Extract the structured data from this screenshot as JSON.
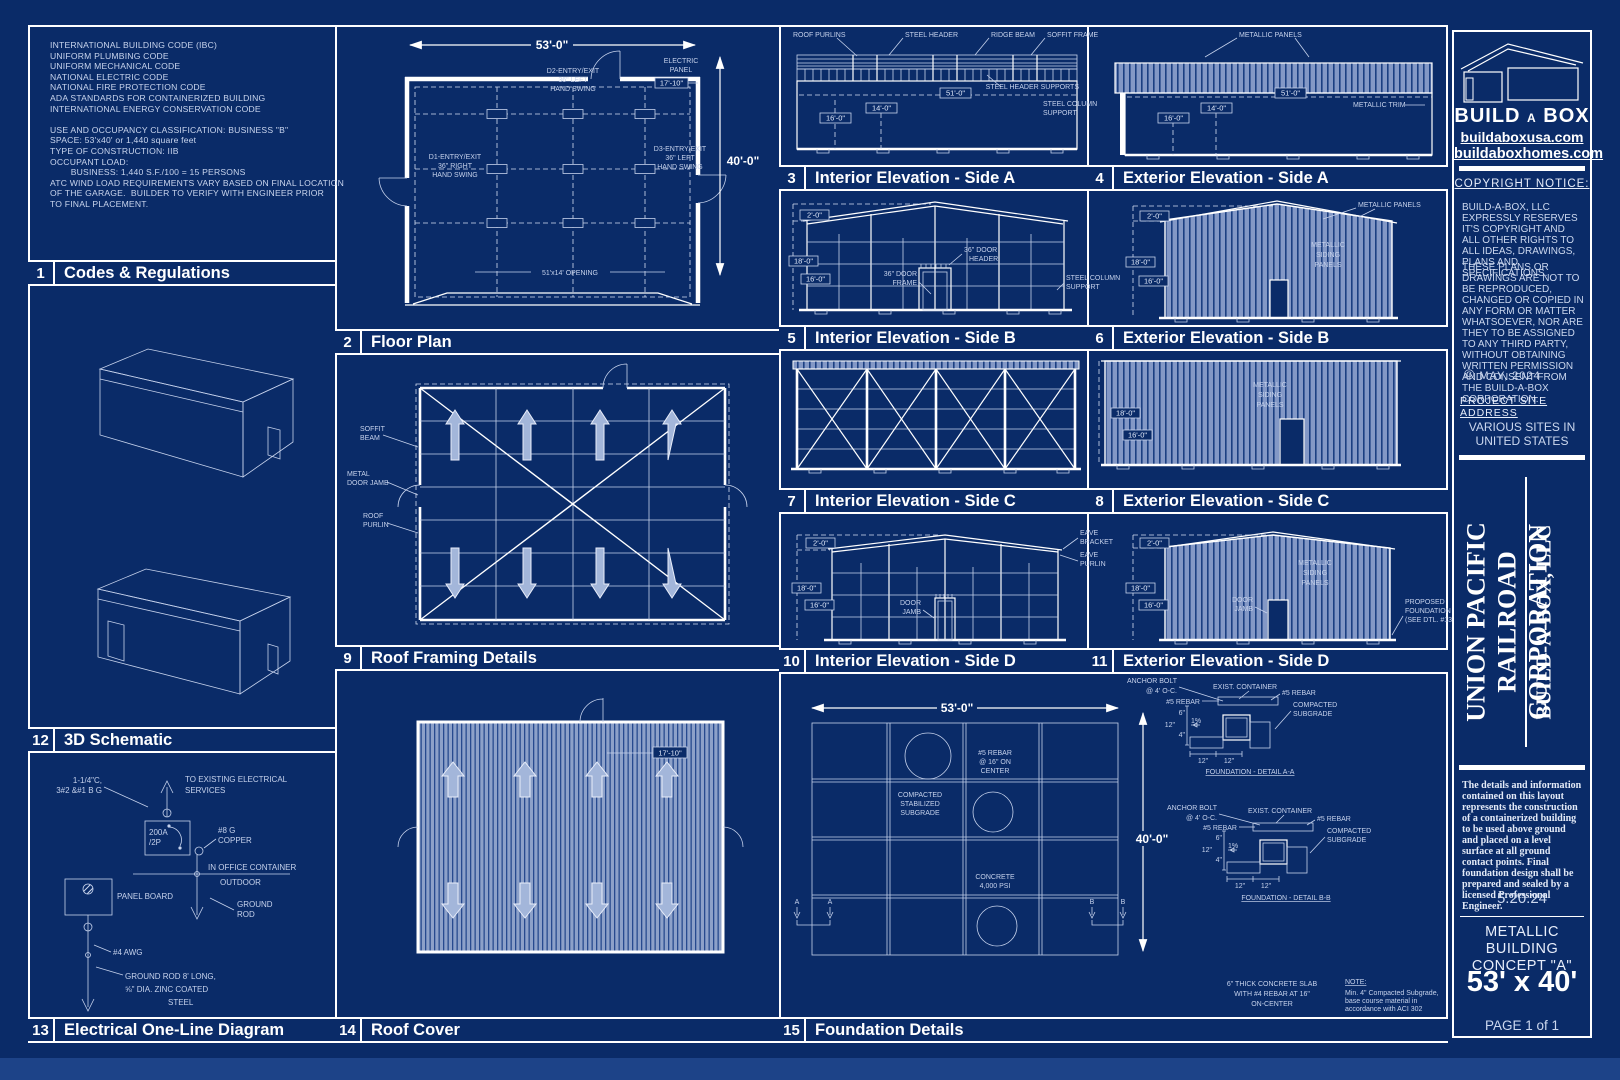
{
  "p1": {
    "num": "1",
    "title": "Codes & Regulations",
    "lines": [
      "INTERNATIONAL BUILDING CODE (IBC)",
      "UNIFORM PLUMBING CODE",
      "UNIFORM MECHANICAL CODE",
      "NATIONAL ELECTRIC CODE",
      "NATIONAL FIRE PROTECTION CODE",
      "ADA STANDARDS FOR CONTAINERIZED BUILDING",
      "INTERNATIONAL ENERGY CONSERVATION CODE",
      "",
      "USE AND OCCUPANCY CLASSIFICATION: BUSINESS \"B\"",
      "SPACE: 53'x40' or 1,440 square feet",
      "TYPE OF CONSTRUCTION: IIB",
      "OCCUPANT LOAD:",
      "        BUSINESS: 1,440 S.F./100 = 15 PERSONS",
      "ATC WIND LOAD REQUIREMENTS VARY BASED ON FINAL LOCATION",
      "OF THE GARAGE.  BUILDER TO VERIFY WITH ENGINEER PRIOR",
      "TO FINAL PLACEMENT."
    ]
  },
  "p2": {
    "num": "2",
    "title": "Floor Plan",
    "dim_w": "53'-0\"",
    "dim_h": "40'-0\"",
    "d1": [
      "D1-ENTRY/EXIT",
      "36\" RIGHT",
      "HAND SWING"
    ],
    "d2": [
      "D2-ENTRY/EXIT",
      "36\" LEFT",
      "HAND SWING"
    ],
    "d3": [
      "D3-ENTRY/EXIT",
      "36\" LEFT",
      "HAND SWING"
    ],
    "electric": [
      "ELECTRIC",
      "PANEL"
    ],
    "panel_dim": "17'-10\"",
    "opening": "51'x14' OPENING"
  },
  "p3": {
    "num": "3",
    "title": "Interior Elevation - Side A",
    "roof_purlins": "ROOF PURLINS",
    "steel_header": "STEEL HEADER",
    "ridge_beam": "RIDGE BEAM",
    "soffit_frame": "SOFFIT FRAME",
    "header_supports": "STEEL HEADER SUPPORTS",
    "column_support": [
      "STEEL COLUMN",
      "SUPPORT"
    ],
    "dims": [
      "16'-0\"",
      "14'-0\"",
      "51'-0\""
    ]
  },
  "p4": {
    "num": "4",
    "title": "Exterior Elevation - Side A",
    "metallic_panels": "METALLIC PANELS",
    "metallic_trim": "METALLIC TRIM",
    "dims": [
      "16'-0\"",
      "14'-0\"",
      "51'-0\""
    ]
  },
  "p5": {
    "num": "5",
    "title": "Interior Elevation - Side B",
    "door_header": [
      "36\" DOOR",
      "HEADER"
    ],
    "door_frame": [
      "36\" DOOR",
      "FRAME"
    ],
    "column_support": [
      "STEEL COLUMN",
      "SUPPORT"
    ],
    "dims": [
      "2'-0\"",
      "18'-0\"",
      "16'-0\""
    ]
  },
  "p6": {
    "num": "6",
    "title": "Exterior Elevation - Side B",
    "metallic_panels": "METALLIC PANELS",
    "siding": [
      "METALLIC",
      "SIDING",
      "PANELS"
    ],
    "dims": [
      "2'-0\"",
      "18'-0\"",
      "16'-0\""
    ]
  },
  "p7": {
    "num": "7",
    "title": "Interior Elevation - Side C"
  },
  "p8": {
    "num": "8",
    "title": "Exterior Elevation - Side C",
    "siding": [
      "METALLIC",
      "SIDING",
      "PANELS"
    ],
    "dims": [
      "18'-0\"",
      "16'-0\""
    ]
  },
  "p9": {
    "num": "9",
    "title": "Roof Framing Details",
    "soffit_beam": [
      "SOFFIT",
      "BEAM"
    ],
    "door_jamb": [
      "METAL",
      "DOOR JAMB"
    ],
    "roof_purlin": [
      "ROOF",
      "PURLIN"
    ]
  },
  "p10": {
    "num": "10",
    "title": "Interior Elevation - Side D",
    "door_jamb": [
      "DOOR",
      "JAMB"
    ],
    "eave_bracket": [
      "EAVE",
      "BRACKET"
    ],
    "eave_purlin": [
      "EAVE",
      "PURLIN"
    ],
    "dims": [
      "2'-0\"",
      "18'-0\"",
      "16'-0\""
    ]
  },
  "p11": {
    "num": "11",
    "title": "Exterior Elevation - Side D",
    "door_jamb": [
      "DOOR",
      "JAMB"
    ],
    "siding": [
      "METALLIC",
      "SIDING",
      "PANELS"
    ],
    "foundation": [
      "PROPOSED",
      "FOUNDATION",
      "(SEE DTL. #13)"
    ],
    "dims": [
      "2'-0\"",
      "18'-0\"",
      "16'-0\""
    ]
  },
  "p12": {
    "num": "12",
    "title": "3D Schematic"
  },
  "p13": {
    "num": "13",
    "title": "Electrical One-Line Diagram",
    "feed": [
      "1-1/4\"C,",
      "3#2 &#1 B G"
    ],
    "services": [
      "TO EXISTING ELECTRICAL",
      "SERVICES"
    ],
    "breaker": [
      "200A",
      "/2P"
    ],
    "copper": [
      "#8 G",
      "COPPER"
    ],
    "in_office": "IN OFFICE CONTAINER",
    "outdoor": "OUTDOOR",
    "panel_board": "PANEL BOARD",
    "ground_rod": [
      "GROUND",
      "ROD"
    ],
    "awg": "#4 AWG",
    "rod_note": [
      "GROUND ROD 8' LONG,",
      "⅝\" DIA. ZINC COATED",
      "STEEL"
    ]
  },
  "p14": {
    "num": "14",
    "title": "Roof Cover",
    "dim": "17'-10\""
  },
  "p15": {
    "num": "15",
    "title": "Foundation Details",
    "dim_w": "53'-0\"",
    "dim_h": "40'-0\"",
    "rebar": [
      "#5 REBAR",
      "@ 16\" ON",
      "CENTER"
    ],
    "subgrade": [
      "COMPACTED",
      "STABILIZED",
      "SUBGRADE"
    ],
    "concrete": [
      "CONCRETE",
      "4,000 PSI"
    ],
    "marker_a": "A",
    "marker_b": "B",
    "detail_a": {
      "anchor": [
        "ANCHOR BOLT",
        "@ 4' O-C."
      ],
      "rebar_l": "#5 REBAR",
      "container": "EXIST. CONTAINER",
      "rebar_r": "#5 REBAR",
      "compacted": [
        "COMPACTED",
        "SUBGRADE"
      ],
      "d6": "6\"",
      "d12": "12\"",
      "d4": "4\"",
      "slope": "1%",
      "d12b": "12\"",
      "d12c": "12\"",
      "title": "FOUNDATION - DETAIL A-A"
    },
    "detail_b": {
      "anchor": [
        "ANCHOR BOLT",
        "@ 4' O-C."
      ],
      "rebar_l": "#5 REBAR",
      "container": "EXIST. CONTAINER",
      "rebar_r": "#5 REBAR",
      "compacted": [
        "COMPACTED",
        "SUBGRADE"
      ],
      "d6": "6\"",
      "d12": "12\"",
      "d4": "4\"",
      "slope": "1%",
      "d12b": "12\"",
      "d12c": "12\"",
      "title": "FOUNDATION - DETAIL B-B"
    },
    "slab": [
      "6\" THICK CONCRETE SLAB",
      "WITH #4 REBAR AT 16\"",
      "ON-CENTER"
    ],
    "note_title": "NOTE:",
    "note": [
      "Min. 4\" Compacted Subgrade,",
      "base course material in",
      "accordance with ACI 302"
    ]
  },
  "sidebar": {
    "logo_parts": [
      "BUILD",
      "A",
      "BOX"
    ],
    "url1": "buildaboxusa.com",
    "url2": "buildaboxhomes.com",
    "copyright_title": "COPYRIGHT NOTICE:",
    "copyright_p1": "BUILD-A-BOX, LLC EXPRESSLY RESERVES  IT'S COPYRIGHT AND ALL OTHER RIGHTS TO ALL IDEAS, DRAWINGS, PLANS AND SPECIFICATIONS.",
    "copyright_p2": "THESE PLANS OR DRAWINGS ARE NOT TO BE REPRODUCED, CHANGED OR COPIED IN ANY FORM OR MATTER WHATSOEVER, NOR ARE THEY TO BE ASSIGNED TO ANY THIRD PARTY, WITHOUT OBTAINING WRITTEN PERMISSION AND CONSENT FROM THE BUILD-A-BOX CORPORATION.",
    "copyright_symbol": "©",
    "copyright_date": "MAY, 2024",
    "site_label": "PROJECT SITE ADDRESS",
    "site_value": [
      "VARIOUS SITES IN",
      "UNITED STATES"
    ],
    "client": [
      "UNION PACIFIC",
      "RAILROAD CORPORATION"
    ],
    "company": "BUILD-A-BOX, LLC",
    "disclaimer": "The details and information contained on this layout represents the construction of a containerized building to be used above ground and placed on a level surface at all ground contact points.  Final foundation design shall be prepared and sealed by a licensed Professional Engineer.",
    "date": "5.20.24",
    "concept": [
      "METALLIC BUILDING",
      "CONCEPT \"A\""
    ],
    "size": "53' x 40'",
    "page": "PAGE 1 of 1"
  }
}
